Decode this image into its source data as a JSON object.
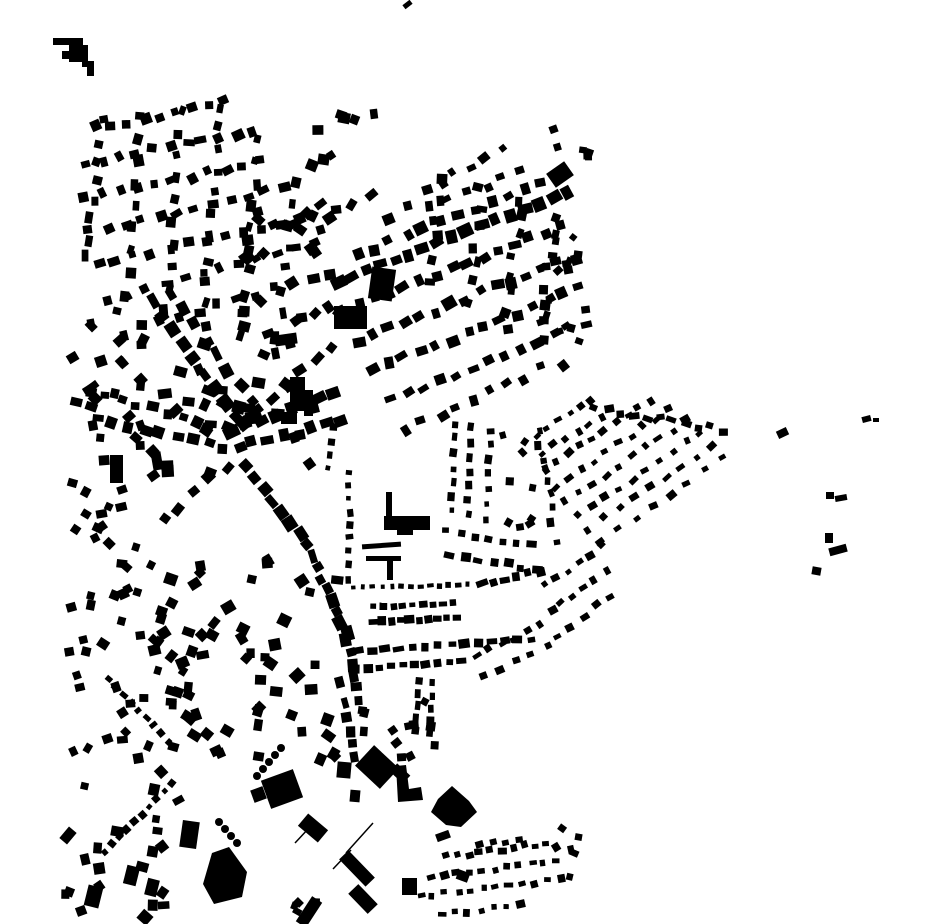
{
  "map": {
    "name": "building-footprint-figure-ground-map",
    "type": "figure-ground building footprints, no labels",
    "width": 930,
    "height": 924,
    "background_color": "#ffffff",
    "building_color": "#000000",
    "seed": 12,
    "landmark_rects": [
      [
        53,
        38,
        30,
        7,
        0
      ],
      [
        69,
        45,
        19,
        17,
        0
      ],
      [
        62,
        51,
        8,
        8,
        0
      ],
      [
        82,
        61,
        12,
        6,
        0
      ],
      [
        87,
        65,
        7,
        11,
        0
      ],
      [
        403,
        2,
        9,
        5,
        -38
      ],
      [
        549,
        166,
        22,
        17,
        -35
      ],
      [
        370,
        268,
        24,
        32,
        8
      ],
      [
        334,
        306,
        33,
        23,
        0
      ],
      [
        275,
        334,
        22,
        11,
        -8
      ],
      [
        290,
        377,
        15,
        34,
        0
      ],
      [
        304,
        390,
        9,
        26,
        0
      ],
      [
        281,
        412,
        16,
        12,
        0
      ],
      [
        110,
        455,
        13,
        28,
        0
      ],
      [
        152,
        452,
        10,
        18,
        -10
      ],
      [
        384,
        516,
        46,
        14,
        0
      ],
      [
        397,
        529,
        16,
        6,
        0
      ],
      [
        362,
        543,
        39,
        5,
        -4
      ],
      [
        366,
        556,
        35,
        5,
        0
      ],
      [
        387,
        560,
        6,
        20,
        0
      ],
      [
        386,
        492,
        6,
        24,
        0
      ],
      [
        265,
        774,
        34,
        30,
        -20
      ],
      [
        252,
        788,
        13,
        13,
        -20
      ],
      [
        360,
        753,
        34,
        28,
        43
      ],
      [
        391,
        768,
        18,
        11,
        43
      ],
      [
        181,
        821,
        17,
        27,
        8
      ],
      [
        436,
        832,
        14,
        8,
        -20
      ],
      [
        338,
        862,
        38,
        13,
        46
      ],
      [
        349,
        892,
        28,
        14,
        46
      ],
      [
        303,
        897,
        12,
        30,
        33
      ],
      [
        300,
        820,
        26,
        16,
        40
      ],
      [
        402,
        878,
        15,
        17,
        0
      ],
      [
        457,
        871,
        12,
        10,
        20
      ],
      [
        86,
        886,
        15,
        21,
        14
      ],
      [
        125,
        866,
        13,
        19,
        14
      ],
      [
        146,
        879,
        12,
        17,
        14
      ],
      [
        63,
        828,
        10,
        15,
        40
      ],
      [
        337,
        762,
        14,
        16,
        5
      ],
      [
        350,
        790,
        10,
        12,
        5
      ],
      [
        862,
        416,
        9,
        6,
        -15
      ],
      [
        873,
        418,
        6,
        4,
        0
      ],
      [
        777,
        429,
        11,
        8,
        -25
      ],
      [
        826,
        492,
        8,
        7,
        0
      ],
      [
        835,
        495,
        12,
        6,
        -10
      ],
      [
        825,
        533,
        8,
        10,
        0
      ],
      [
        829,
        546,
        18,
        8,
        -15
      ],
      [
        812,
        567,
        9,
        8,
        10
      ]
    ],
    "landmark_polygons": [
      [
        [
          396,
          766
        ],
        [
          406,
          765
        ],
        [
          409,
          789
        ],
        [
          421,
          787
        ],
        [
          423,
          800
        ],
        [
          398,
          802
        ]
      ],
      [
        [
          438,
          799
        ],
        [
          452,
          786
        ],
        [
          469,
          801
        ],
        [
          477,
          812
        ],
        [
          461,
          827
        ],
        [
          446,
          825
        ],
        [
          431,
          812
        ]
      ],
      [
        [
          203,
          884
        ],
        [
          212,
          853
        ],
        [
          229,
          847
        ],
        [
          247,
          872
        ],
        [
          242,
          897
        ],
        [
          214,
          904
        ]
      ]
    ],
    "rows": [
      [
        97,
        128,
        225,
        103,
        9,
        9,
        8,
        3,
        18
      ],
      [
        88,
        163,
        252,
        132,
        11,
        9,
        8,
        3,
        18
      ],
      [
        86,
        198,
        262,
        162,
        11,
        9,
        8,
        3,
        18
      ],
      [
        90,
        232,
        282,
        188,
        12,
        9,
        8,
        3,
        18
      ],
      [
        97,
        266,
        300,
        218,
        12,
        9,
        8,
        3,
        18
      ],
      [
        110,
        300,
        312,
        243,
        12,
        9,
        8,
        3,
        18
      ],
      [
        122,
        333,
        330,
        272,
        12,
        10,
        9,
        3,
        18
      ],
      [
        101,
        122,
        88,
        258,
        8,
        9,
        8,
        3,
        18
      ],
      [
        141,
        116,
        126,
        296,
        9,
        9,
        8,
        3,
        18
      ],
      [
        181,
        111,
        166,
        308,
        10,
        9,
        8,
        3,
        18
      ],
      [
        221,
        106,
        204,
        326,
        11,
        9,
        8,
        3,
        18
      ],
      [
        258,
        140,
        242,
        338,
        10,
        9,
        8,
        3,
        18
      ],
      [
        294,
        182,
        276,
        356,
        9,
        9,
        8,
        3,
        18
      ],
      [
        337,
        282,
        568,
        192,
        17,
        12,
        10,
        2,
        10
      ],
      [
        356,
        256,
        558,
        177,
        13,
        10,
        9,
        3,
        12
      ],
      [
        392,
        216,
        522,
        172,
        8,
        9,
        8,
        4,
        15
      ],
      [
        425,
        187,
        500,
        152,
        6,
        8,
        7,
        4,
        15
      ],
      [
        342,
        311,
        560,
        227,
        15,
        10,
        9,
        3,
        12
      ],
      [
        357,
        341,
        574,
        257,
        15,
        10,
        9,
        3,
        12
      ],
      [
        372,
        371,
        580,
        287,
        14,
        10,
        9,
        3,
        12
      ],
      [
        391,
        401,
        585,
        322,
        13,
        9,
        8,
        3,
        12
      ],
      [
        407,
        430,
        560,
        362,
        10,
        9,
        8,
        4,
        15
      ],
      [
        440,
        180,
        432,
        278,
        6,
        8,
        8,
        4,
        15
      ],
      [
        481,
        191,
        470,
        300,
        7,
        8,
        8,
        4,
        15
      ],
      [
        520,
        200,
        506,
        330,
        8,
        8,
        8,
        4,
        15
      ],
      [
        556,
        216,
        541,
        341,
        8,
        8,
        8,
        4,
        15
      ],
      [
        596,
        409,
        724,
        430,
        11,
        8,
        6,
        3,
        20
      ],
      [
        537,
        436,
        592,
        400,
        6,
        7,
        6,
        2,
        12
      ],
      [
        542,
        453,
        602,
        416,
        6,
        7,
        6,
        2,
        12
      ],
      [
        546,
        470,
        650,
        400,
        10,
        7,
        6,
        2,
        12
      ],
      [
        556,
        486,
        668,
        410,
        10,
        7,
        6,
        2,
        12
      ],
      [
        566,
        501,
        686,
        421,
        10,
        7,
        6,
        2,
        12
      ],
      [
        577,
        515,
        701,
        433,
        10,
        7,
        6,
        2,
        12
      ],
      [
        589,
        529,
        712,
        446,
        9,
        7,
        6,
        2,
        12
      ],
      [
        601,
        542,
        721,
        459,
        8,
        7,
        6,
        2,
        12
      ],
      [
        538,
        432,
        556,
        540,
        8,
        7,
        6,
        3,
        15
      ],
      [
        152,
        301,
        236,
        419,
        9,
        12,
        10,
        2,
        10
      ],
      [
        172,
        292,
        252,
        404,
        8,
        11,
        9,
        3,
        12
      ],
      [
        92,
        392,
        228,
        428,
        10,
        11,
        9,
        3,
        12
      ],
      [
        97,
        421,
        224,
        447,
        9,
        10,
        9,
        3,
        12
      ],
      [
        232,
        432,
        332,
        392,
        8,
        12,
        10,
        2,
        10
      ],
      [
        238,
        448,
        342,
        420,
        8,
        11,
        10,
        3,
        10
      ],
      [
        243,
        421,
        330,
        347,
        7,
        11,
        10,
        3,
        12
      ],
      [
        247,
        466,
        308,
        546,
        8,
        11,
        10,
        2,
        10
      ],
      [
        312,
        556,
        346,
        634,
        8,
        11,
        9,
        2,
        8
      ],
      [
        347,
        641,
        359,
        700,
        6,
        10,
        9,
        2,
        8
      ],
      [
        228,
        466,
        162,
        521,
        5,
        9,
        8,
        4,
        15
      ],
      [
        354,
        587,
        468,
        585,
        13,
        5,
        5,
        1,
        5
      ],
      [
        350,
        472,
        348,
        578,
        9,
        6,
        6,
        2,
        8
      ],
      [
        332,
        428,
        328,
        470,
        4,
        6,
        6,
        2,
        8
      ],
      [
        456,
        424,
        452,
        512,
        7,
        7,
        6,
        2,
        8
      ],
      [
        471,
        427,
        467,
        515,
        7,
        7,
        6,
        2,
        8
      ],
      [
        491,
        430,
        487,
        519,
        7,
        7,
        6,
        2,
        8
      ],
      [
        446,
        532,
        532,
        545,
        7,
        8,
        7,
        2,
        8
      ],
      [
        451,
        556,
        536,
        569,
        7,
        8,
        7,
        2,
        8
      ],
      [
        546,
        586,
        601,
        546,
        6,
        7,
        6,
        2,
        10
      ],
      [
        551,
        611,
        606,
        571,
        6,
        7,
        6,
        2,
        10
      ],
      [
        556,
        636,
        611,
        596,
        5,
        7,
        6,
        2,
        10
      ],
      [
        476,
        656,
        541,
        626,
        6,
        7,
        6,
        2,
        10
      ],
      [
        482,
        676,
        547,
        646,
        5,
        7,
        6,
        2,
        10
      ],
      [
        481,
        584,
        539,
        571,
        6,
        9,
        7,
        2,
        8
      ],
      [
        373,
        607,
        453,
        603,
        9,
        7,
        6,
        1,
        5
      ],
      [
        373,
        622,
        456,
        618,
        10,
        8,
        7,
        1,
        5
      ],
      [
        359,
        651,
        531,
        639,
        14,
        9,
        7,
        1,
        6
      ],
      [
        356,
        669,
        461,
        661,
        10,
        8,
        7,
        1,
        6
      ],
      [
        419,
        681,
        416,
        731,
        5,
        7,
        6,
        1,
        5
      ],
      [
        433,
        683,
        430,
        733,
        5,
        7,
        6,
        1,
        5
      ],
      [
        108,
        679,
        169,
        741,
        9,
        6,
        6,
        1,
        8
      ],
      [
        172,
        784,
        104,
        852,
        10,
        6,
        6,
        1,
        8
      ],
      [
        345,
        703,
        354,
        758,
        5,
        9,
        8,
        2,
        8
      ],
      [
        447,
        857,
        546,
        843,
        10,
        7,
        6,
        2,
        10
      ],
      [
        432,
        877,
        556,
        861,
        11,
        7,
        6,
        2,
        10
      ],
      [
        420,
        897,
        560,
        879,
        12,
        7,
        6,
        2,
        10
      ],
      [
        441,
        915,
        521,
        905,
        7,
        7,
        6,
        2,
        10
      ],
      [
        478,
        846,
        520,
        839,
        4,
        7,
        6,
        2,
        10
      ]
    ],
    "scatters": [
      [
        282,
        112,
        100,
        118,
        16,
        7,
        12
      ],
      [
        543,
        126,
        55,
        52,
        6,
        6,
        10
      ],
      [
        540,
        232,
        52,
        116,
        15,
        6,
        9
      ],
      [
        72,
        300,
        80,
        215,
        26,
        7,
        12
      ],
      [
        140,
        335,
        200,
        140,
        30,
        8,
        14
      ],
      [
        235,
        205,
        110,
        130,
        20,
        8,
        12
      ],
      [
        500,
        432,
        46,
        96,
        10,
        6,
        9
      ],
      [
        66,
        470,
        95,
        190,
        30,
        7,
        11
      ],
      [
        70,
        662,
        115,
        100,
        20,
        7,
        11
      ],
      [
        60,
        766,
        120,
        152,
        22,
        7,
        13
      ],
      [
        150,
        560,
        190,
        108,
        34,
        8,
        13
      ],
      [
        180,
        672,
        160,
        90,
        26,
        8,
        13
      ],
      [
        362,
        700,
        75,
        58,
        12,
        7,
        10
      ],
      [
        525,
        828,
        70,
        60,
        6,
        6,
        9
      ],
      [
        283,
        900,
        40,
        22,
        4,
        6,
        9
      ]
    ],
    "dot_circles": [
      [
        257,
        776,
        4
      ],
      [
        263,
        769,
        4
      ],
      [
        269,
        762,
        4
      ],
      [
        275,
        755,
        4
      ],
      [
        281,
        748,
        4
      ],
      [
        219,
        822,
        4
      ],
      [
        225,
        829,
        4
      ],
      [
        231,
        836,
        4
      ],
      [
        237,
        843,
        4
      ]
    ],
    "thin_lines": [
      [
        295,
        843,
        309,
        828,
        1.5
      ],
      [
        333,
        869,
        351,
        850,
        1.5
      ],
      [
        346,
        853,
        373,
        823,
        1.5
      ]
    ]
  }
}
